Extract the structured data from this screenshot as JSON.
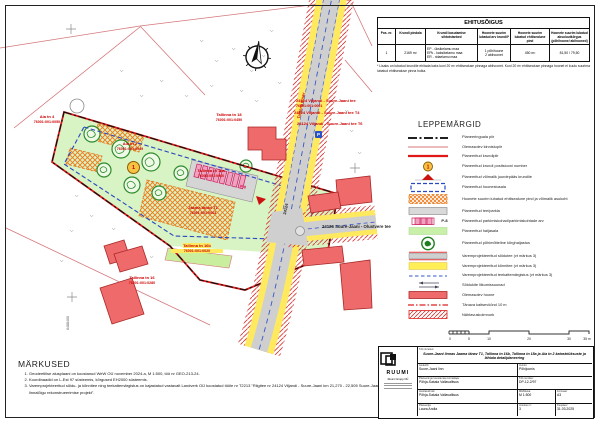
{
  "table": {
    "title": "EHITUSÕIGUS",
    "headers": [
      "Pos. nr.",
      "Krundi pindala",
      "Krundi kasutamise sihtotstarbed",
      "Hoonete suurim lubatud arv krundil*",
      "Hoonete suurim lubatud ehitisealune pind",
      "Hoonete suurim lubatud absoluutkõrgus (põhihoone/ abihooned)"
    ],
    "row": {
      "pos": "1",
      "area": "2169 m²",
      "uses": [
        "EP - üksikelamu maa",
        "EPk - kaksikelamu maa",
        "ER - ridaelamu maa"
      ],
      "count": [
        "1 põhihoone",
        "2 abihoonet"
      ],
      "footprint": "450 m²",
      "height": "81,50 / 79,50"
    },
    "footnote": "* Lisaks on lubatud krundile ehitada kaks kuni 20 m² ehitisealuse pinnaga abihoonet. Kuni 20 m² ehitisealuse pinnaga hoonet ei kuulu suurima lubatud ehitisealuse pinna hulka."
  },
  "legend": {
    "title": "LEPPEMÄRGID",
    "items": [
      {
        "label": "Planeeringuala piir"
      },
      {
        "label": "Olemasolev kinnistupiir"
      },
      {
        "label": "Planeeritud krundipiir"
      },
      {
        "label": "Planeeritud krundi positsiooni number",
        "sample": "1"
      },
      {
        "label": "Planeeritud võimalik juurdepääs krundile"
      },
      {
        "label": "Planeeritud hoonestusala"
      },
      {
        "label": "Hoonete suurim lubatud ehitisealune pind ja võimalik asukoht"
      },
      {
        "label": "Planeeritud tee/parkla"
      },
      {
        "label": "Planeeritud parkimiskohad/parkimiskohtade arv",
        "badge": "P-8"
      },
      {
        "label": "Planeeritud haljasala"
      },
      {
        "label": "Planeeritud põhimõtteline kõrghaljastus"
      },
      {
        "label": "Varemprojekteeritud sõidutee (vt märkus 3)"
      },
      {
        "label": "Varemprojekteeritud kõnnitee (vt märkus 3)"
      },
      {
        "label": "Varemprojekteeritud teekattemärgistus (vt märkus 3)"
      },
      {
        "label": "Sõidukite liikumissuunad"
      },
      {
        "label": "Olemasolev hoone"
      },
      {
        "label": "Tänava kaitsevöönd 10 m"
      },
      {
        "label": "Nähtavuskolmnurk"
      }
    ]
  },
  "scalebar": {
    "labels": [
      "0",
      "5",
      "10",
      "20",
      "30",
      "35 m"
    ]
  },
  "notes": {
    "title": "MÄRKUSED",
    "items": [
      "Geodeetilise alusplaani on koostanud WeW OÜ november 2024.a, M 1:500, töö nr GEO-213-24.",
      "Koordinaadid on L-Est 97 süsteemis, kõrgused EH2000 süsteemis.",
      "Varemprojekteeritud sõidu- ja kõnnitee ning teekattemärgistus on kajastatud vastavalt Landverk OÜ koostatud tööle nr T2213 \"Riigitee nr 24124 Viljandi - Suure-Jaani km 21,270 - 22,505 Suure-Jaani linnalõigu rekonstrueerimise projekt\"."
    ]
  },
  "titleblock": {
    "company": {
      "name": "RUUMI",
      "sub": "Ruumi Grupp OÜ"
    },
    "project_label": "Töö nimetus:",
    "project": "Suure-Jaani linnas Jaama tänav T1, Tallinna tn 16b, Tallinna tn 18a ja Aia tn 2 katastriüksuste ja lähiala detailplaneering",
    "asukoht_label": "Asukoht:",
    "asukoht": "Suure-Jaani linn",
    "joonis_label": "Joonis:",
    "joonis": "Põhijoonis",
    "korraldaja_label": "Planeeringu koostamise korraldaja:",
    "korraldaja": "Põhja-Sakala Vallavalitsus",
    "too_number_label": "Töö number:",
    "too_number": "DP-12-2/97",
    "huvitatud_label": "Huvitatud isik:",
    "huvitatud": "Põhja-Sakala Vallavalitsus",
    "mootkava_label": "Mõõtkava:",
    "mootkava": "M 1:500",
    "formaat_label": "Formaat:",
    "formaat": "A3",
    "planeerija_label": "Planeerija:",
    "planeerija": "Laura Andla",
    "joonise_nr_label": "Joonise nr:",
    "joonise_nr": "3",
    "kuupaev_label": "Kuupäev:",
    "kuupaev": "31.03.2025"
  },
  "map": {
    "pos_number": "1",
    "parking_badge": "P-8",
    "p_sign": "P",
    "coordinate": "6488400",
    "roads": {
      "diagonal_name": "Tallinna tänav",
      "diagonal_number": "24124",
      "horizontal": "24126 Suure-Jaani - Olustvere tee"
    },
    "labels": [
      {
        "name": "Aia tn 4",
        "cadastre": "76001:001:0050"
      },
      {
        "name": "Aia tn 2",
        "cadastre": "76001:001:0049"
      },
      {
        "name": "Tallinna tn 18",
        "cadastre": "76001:001:0450"
      },
      {
        "name": "Tallinna tn 18a",
        "cadastre": "76001:001:0060"
      },
      {
        "name": "Jaama tänav T1",
        "cadastre": "76001:001:0063"
      },
      {
        "name": "Tallinna tn 16b",
        "cadastre": "76001:001:0020"
      },
      {
        "name": "Tallinna tn 16",
        "cadastre": "76001:001:0280"
      },
      {
        "name": "24124 Viljandi - Suure-Jaani tee",
        "cadastre": "76001:001:0001"
      },
      {
        "name": "24124 Viljandi - Suure-Jaani tee T4",
        "cadastre": ""
      },
      {
        "name": "24124 Viljandi - Suure-Jaani tee T6",
        "cadastre": ""
      }
    ]
  }
}
